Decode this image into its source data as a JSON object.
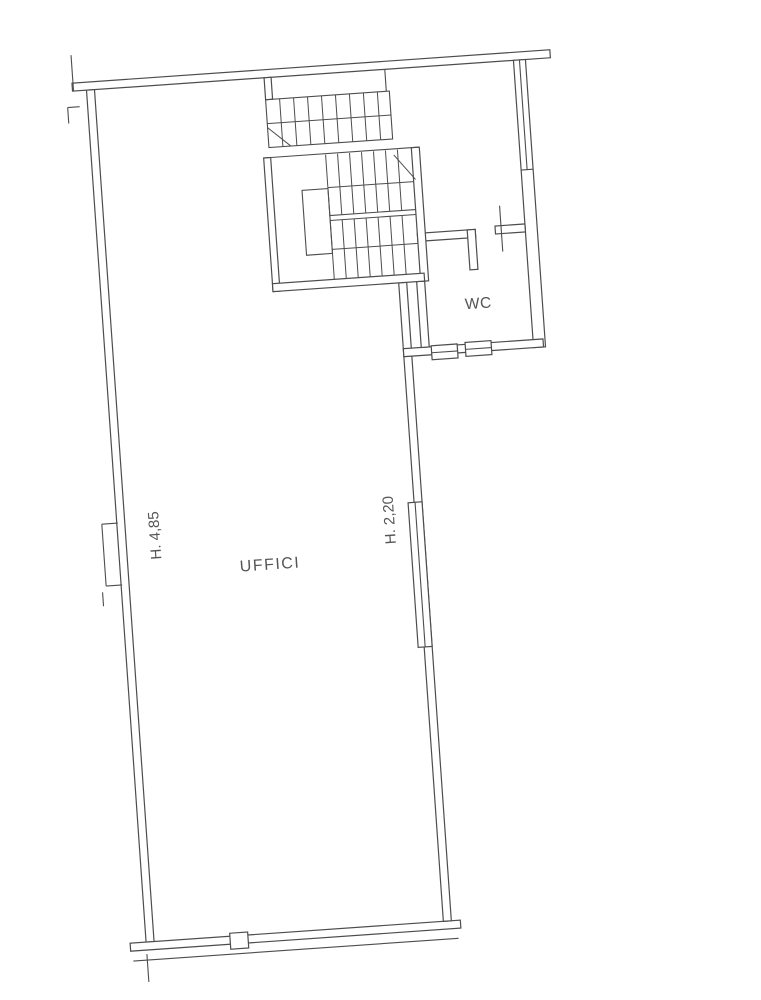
{
  "floor_plan": {
    "room_label": "UFFICI",
    "wc_label": "WC",
    "left_wall_height": "H. 4,85",
    "right_wall_height": "H. 2,20"
  },
  "colors": {
    "line": "#4d4d4d",
    "text": "#555555",
    "background": "#ffffff"
  }
}
